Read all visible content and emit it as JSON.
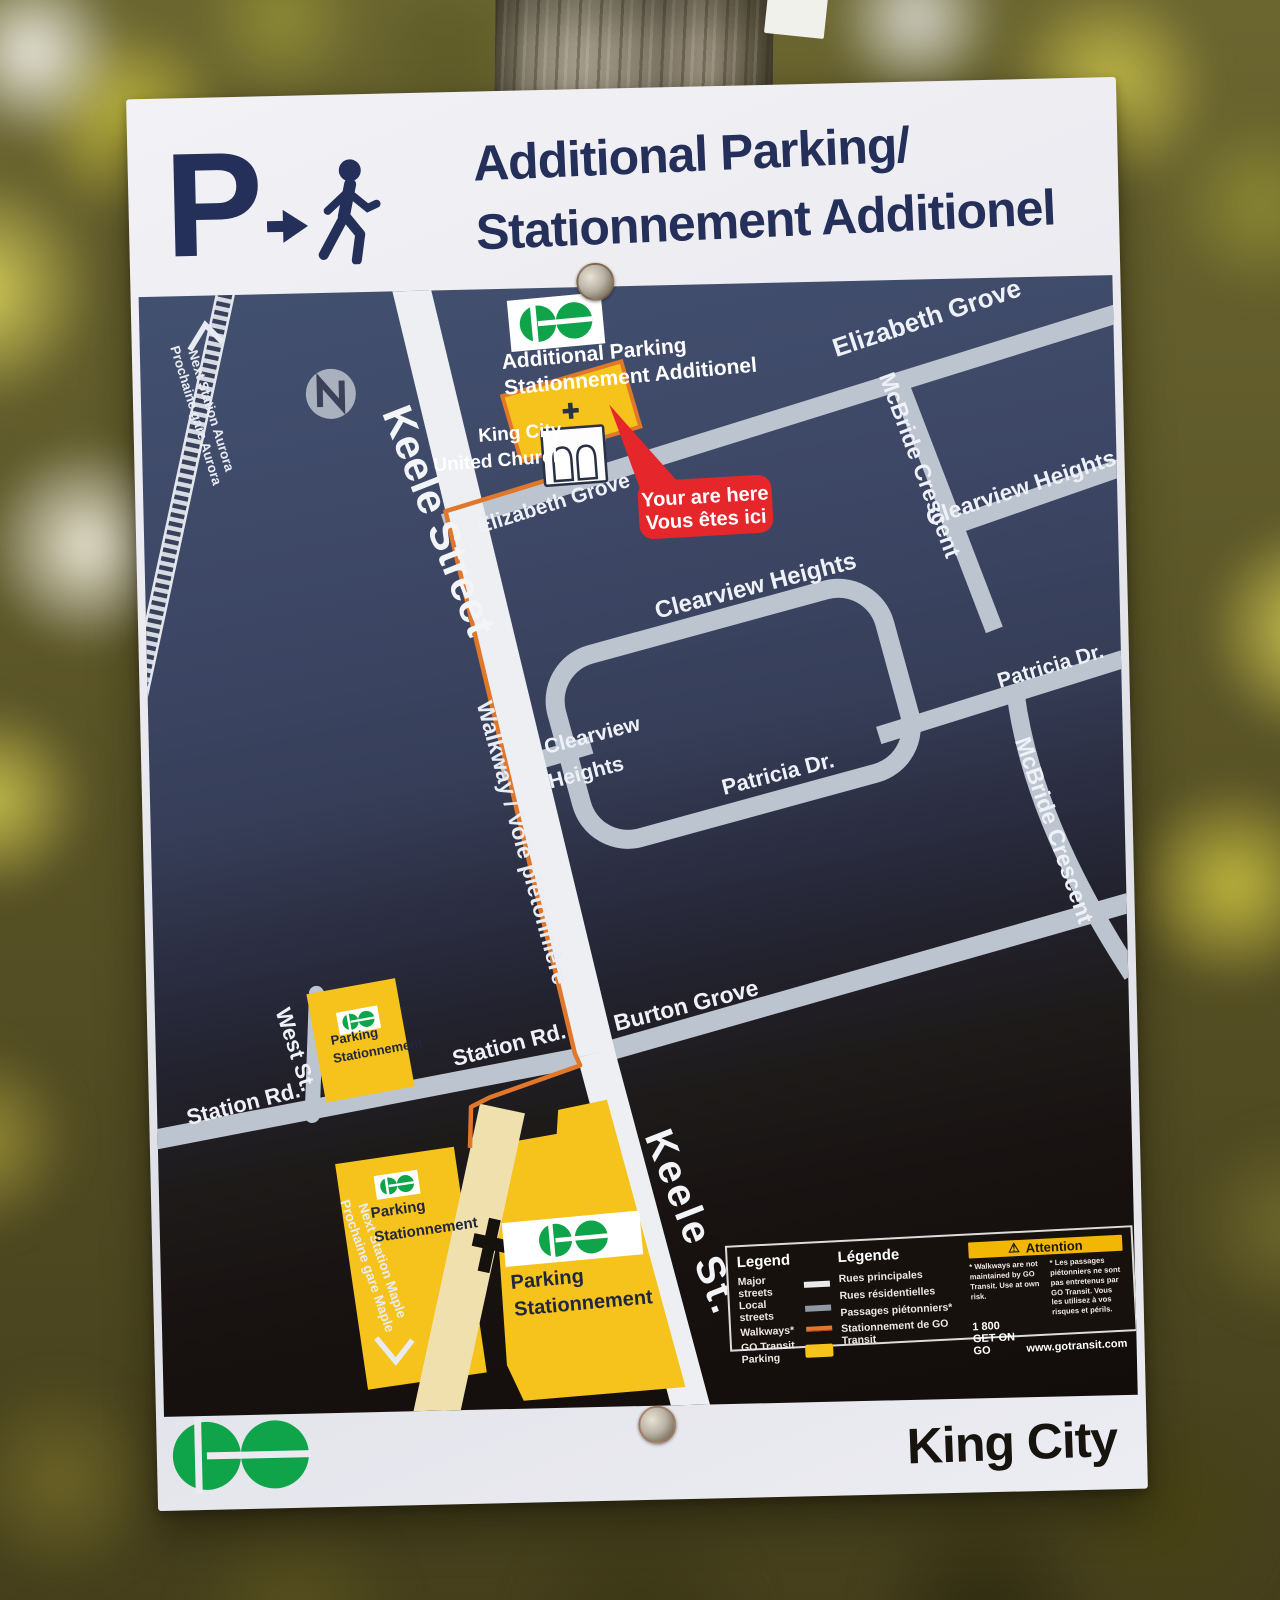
{
  "header": {
    "p_symbol": "P",
    "title_line1": "Additional Parking/",
    "title_line2": "Stationnement Additionel"
  },
  "map": {
    "next_station_top": {
      "line1": "Next Station Aurora",
      "line2": "Prochaine gare Aurora"
    },
    "next_station_bottom": {
      "line1": "Next Station Maple",
      "line2": "Prochaine gare Maple"
    },
    "additional_parking_callout": {
      "line1": "Additional Parking",
      "line2": "Stationnement Additionel"
    },
    "church": {
      "line1": "King City",
      "line2": "United Church"
    },
    "you_are_here": {
      "line1": "Your are here",
      "line2": "Vous êtes ici"
    },
    "walkway_label": "Walkway / Voie piétonnière",
    "streets": {
      "keele_street": "Keele Street",
      "keele_st": "Keele St.",
      "elizabeth_grove_top": "Elizabeth Grove",
      "elizabeth_grove": "Elizabeth Grove",
      "mcbride_crescent_top": "McBride Crescent",
      "mcbride_crescent": "McBride Crescent",
      "clearview_heights_top": "Clearview Heights",
      "clearview_heights_mid": "Clearview Heights",
      "clearview_line1": "Clearview",
      "clearview_line2": "Heights",
      "patricia_dr_inner": "Patricia Dr.",
      "patricia_dr_east": "Patricia Dr.",
      "burton_grove": "Burton Grove",
      "station_rd_mid": "Station Rd.",
      "station_rd_west": "Station Rd.",
      "west_st": "West St."
    },
    "parking_lots": {
      "station_west": {
        "line1": "Parking",
        "line2": "Stationnement"
      },
      "south_west": {
        "line1": "Parking",
        "line2": "Stationnement"
      },
      "main": {
        "line1": "Parking",
        "line2": "Stationnement"
      }
    }
  },
  "legend": {
    "title_en": "Legend",
    "title_fr": "Légende",
    "items": [
      {
        "en": "Major streets",
        "fr": "Rues principales"
      },
      {
        "en": "Local streets",
        "fr": "Rues résidentielles"
      },
      {
        "en": "Walkways*",
        "fr": "Passages piétonniers*"
      },
      {
        "en": "GO Transit Parking",
        "fr": "Stationnement de GO Transit"
      }
    ],
    "attention": {
      "warning_icon": "⚠",
      "title": "Attention",
      "note_en": "* Walkways are not maintained by GO Transit. Use at own risk.",
      "note_fr": "* Les passages piétonniers ne sont pas entretenus par GO Transit. Vous les utilisez à vos risques et périls."
    },
    "phone": "1 800 GET ON GO",
    "website": "www.gotransit.com"
  },
  "footer": {
    "station_name": "King City"
  },
  "colors": {
    "go_green": "#0fa44a",
    "map_navy": "#3d4766",
    "road_gray": "#bcc4d0",
    "keele_white": "#edeff3",
    "parking_yellow": "#f6c21c",
    "walkway_orange": "#e0772b",
    "you_are_here_red": "#e5262b",
    "attention_yellow": "#f2b705",
    "header_navy": "#25305a"
  }
}
